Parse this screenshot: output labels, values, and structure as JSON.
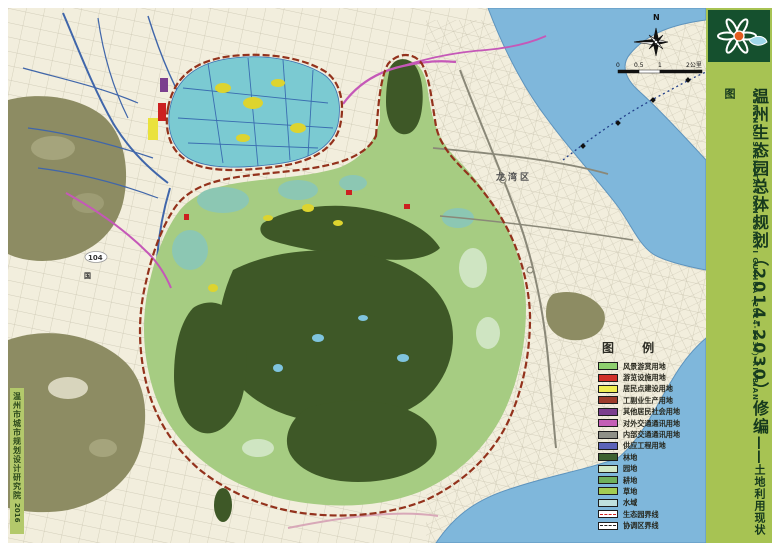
{
  "sidebar": {
    "title_cn": "温州生态园总体规划（2014-2030）修编",
    "title_dash": "——",
    "subtitle_cn": "土地利用现状图",
    "title_en": "WENZHOU SHENGTAIYUAN ZONGTI GUIHUA（2014-2030）XIUBIAN",
    "bg_color": "#a7c353",
    "logo_bg_color": "#15502e",
    "text_color": "#16391d"
  },
  "credit": {
    "institute": "温州市城市规划设计研究院",
    "year": "2016",
    "bg_color": "#b3c96b"
  },
  "map": {
    "labels": {
      "district": "龙湾区",
      "road_number": "104",
      "road_word": "国",
      "north": "N"
    },
    "scale_ticks": {
      "t0": "0",
      "t05": "0.5",
      "t1": "1",
      "t2": "2公里"
    },
    "colors": {
      "land": "#f2eedd",
      "sea": "#7fb7db",
      "hills": "#8d8c63",
      "park_light": "#a6cc82",
      "forest_dark": "#3e5827",
      "wetland": "#7bcad2",
      "boundary": "#93321c"
    }
  },
  "legend": {
    "title": "图 例",
    "items": [
      {
        "label": "风景游赏用地",
        "type": "fill",
        "color": "#8ed06e"
      },
      {
        "label": "游览设施用地",
        "type": "fill",
        "color": "#d03028"
      },
      {
        "label": "居民点建设用地",
        "type": "fill",
        "color": "#f0ee52"
      },
      {
        "label": "工副业生产用地",
        "type": "fill",
        "color": "#9d3b2b"
      },
      {
        "label": "其他居民社会用地",
        "type": "fill",
        "color": "#7b3f8e"
      },
      {
        "label": "对外交通通讯用地",
        "type": "fill",
        "color": "#c45fb6"
      },
      {
        "label": "内部交通通讯用地",
        "type": "fill",
        "color": "#8f9087"
      },
      {
        "label": "供应工程用地",
        "type": "fill",
        "color": "#5c63b8"
      },
      {
        "label": "林地",
        "type": "fill",
        "color": "#3d6130"
      },
      {
        "label": "园地",
        "type": "fill",
        "color": "#d2e8c6"
      },
      {
        "label": "耕地",
        "type": "fill",
        "color": "#6fb05c"
      },
      {
        "label": "草地",
        "type": "fill",
        "color": "#a3cc52"
      },
      {
        "label": "水域",
        "type": "fill",
        "color": "#bfe0df"
      },
      {
        "label": "生态园界线",
        "type": "line",
        "color": "#d02020"
      },
      {
        "label": "协调区界线",
        "type": "line",
        "color": "#222222"
      }
    ]
  }
}
